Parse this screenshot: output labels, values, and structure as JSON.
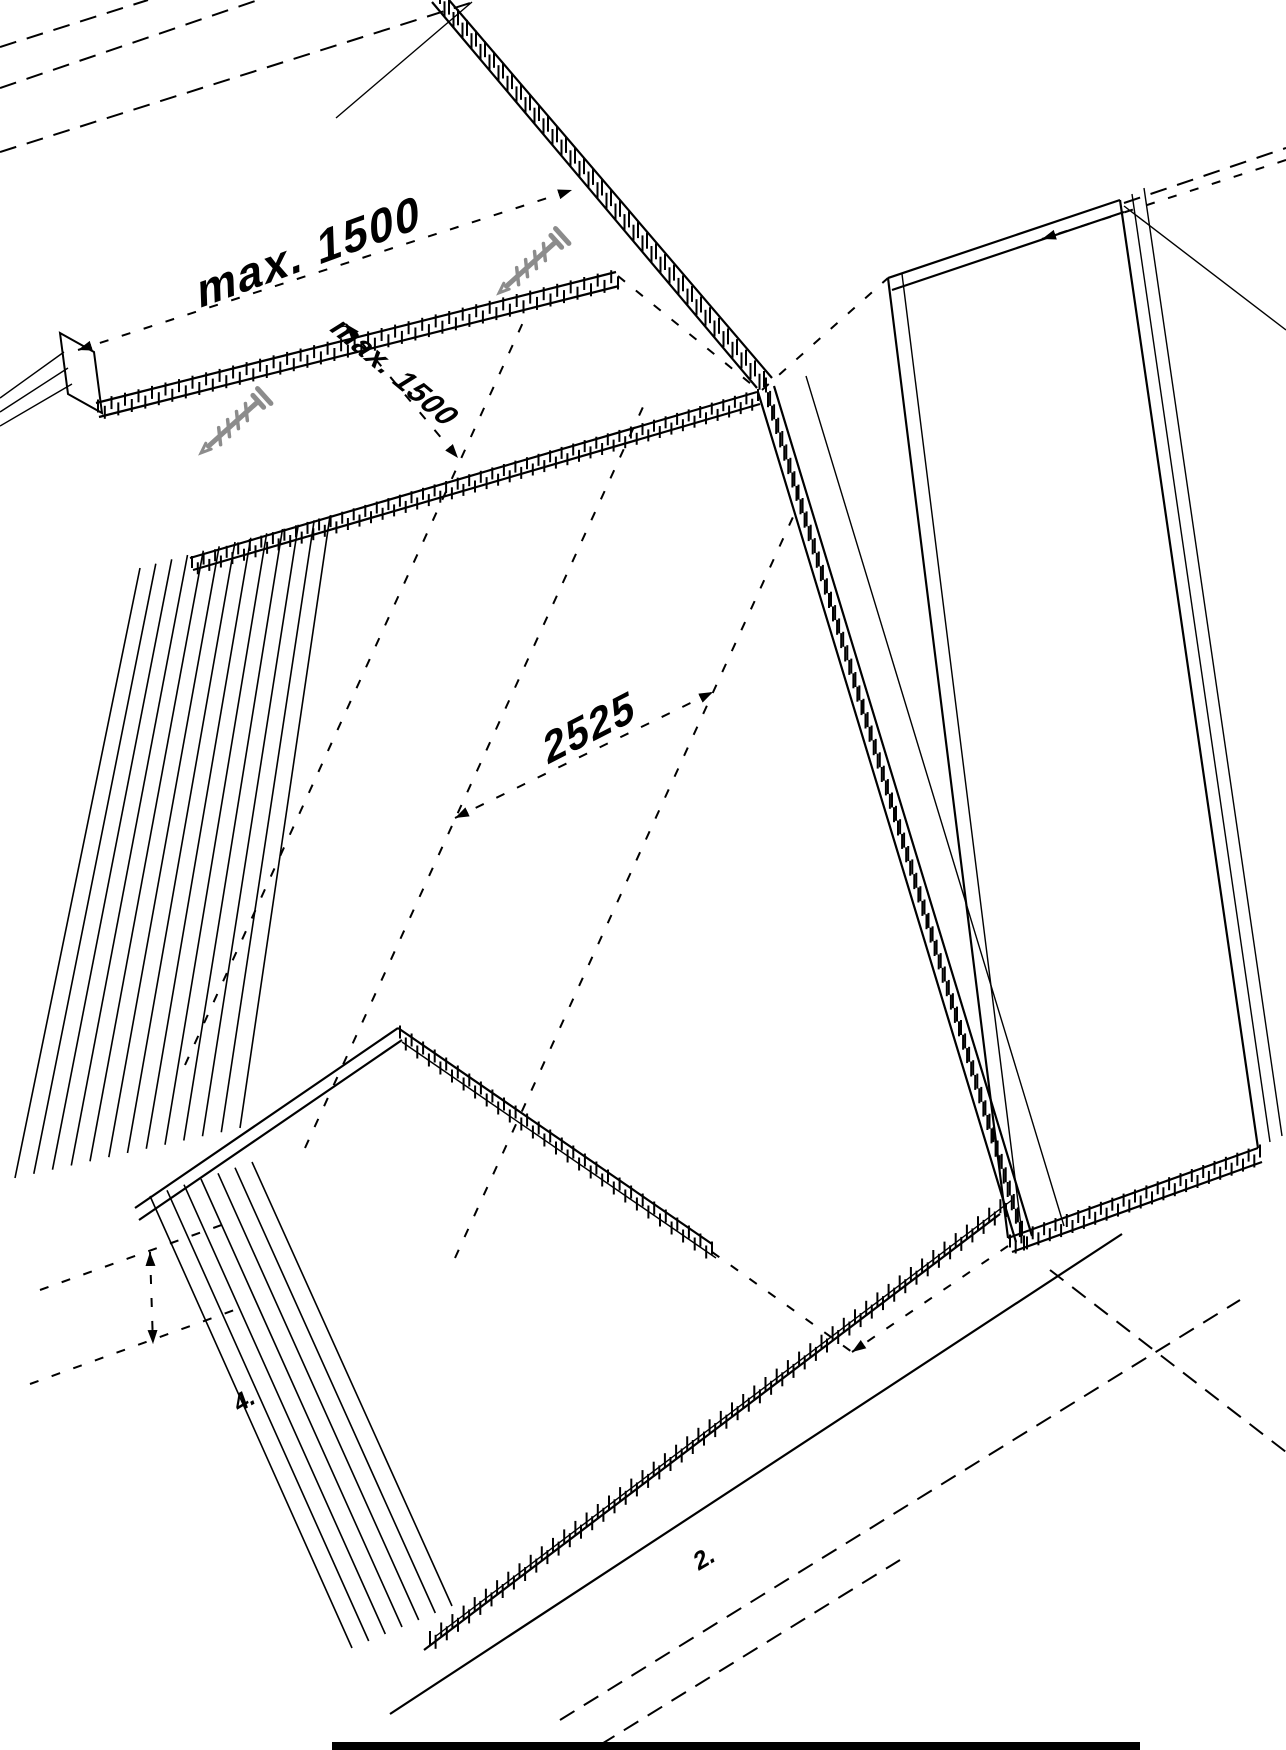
{
  "drawing": {
    "dimensions": {
      "top": "max. 1500",
      "side": "max. 1500",
      "center": "2525"
    },
    "notes": {
      "left": "4.",
      "right": "2."
    },
    "icons": [
      {
        "name": "screw-icon",
        "count": 2
      }
    ],
    "colors": {
      "line": "#000000",
      "screw": "#8c8c8c",
      "background": "#ffffff"
    }
  }
}
